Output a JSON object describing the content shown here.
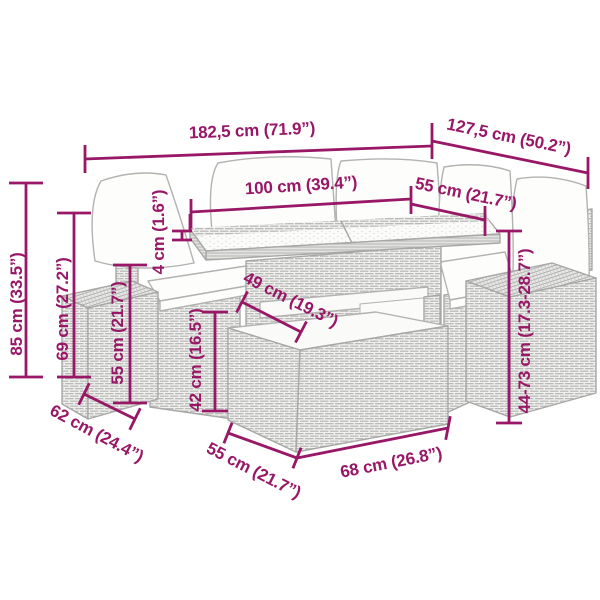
{
  "colors": {
    "dimension_accent": "#981766",
    "artwork_line": "#A7A7A5",
    "background": "#FFFFFF"
  },
  "dims": {
    "total_width": "182,5 cm (71.9”)",
    "total_depth": "127,5 cm (50.2”)",
    "table_length": "100 cm (39.4”)",
    "seat_width": "55 cm (21.7”)",
    "glass_thickness": "4 cm (1.6”)",
    "table_depth": "49 cm (19.3”)",
    "stool_height": "42 cm (16.5”)",
    "side_depth": "62 cm (24.4”)",
    "stool_depth": "55 cm (21.7”)",
    "stool_length": "68 cm (26.8”)",
    "adjustable_height": "44-73 cm (17.3-28.7”)",
    "total_height": "85 cm (33.5”)",
    "back_height": "69 cm (27.2”)",
    "arm_height": "55 cm (21.7”)"
  }
}
